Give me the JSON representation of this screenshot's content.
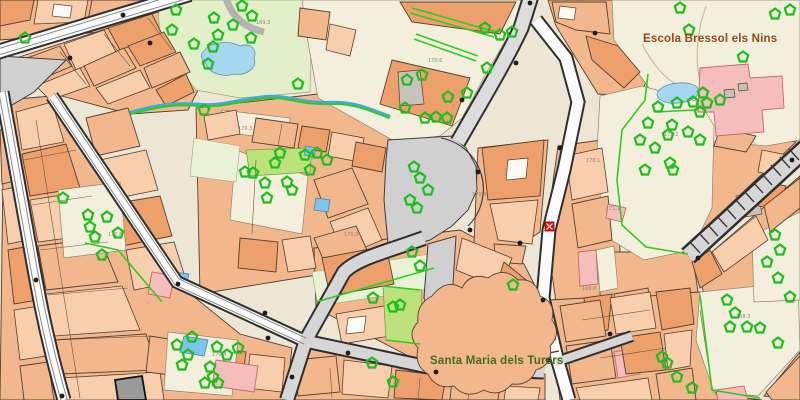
{
  "labels": {
    "poi_school": "Escola Bressol els Nins",
    "poi_church": "Santa Maria dels Turers"
  },
  "spot_heights": [
    {
      "value": "169.3"
    },
    {
      "value": "170.3"
    },
    {
      "value": "170.6"
    },
    {
      "value": "170.4"
    },
    {
      "value": "170.9"
    },
    {
      "value": "170.4"
    },
    {
      "value": "170.8"
    },
    {
      "value": "169.8"
    },
    {
      "value": "170.2"
    },
    {
      "value": "168.3"
    },
    {
      "value": "170.1"
    },
    {
      "value": "171.1"
    }
  ],
  "icons": {
    "tree": "pentagon-tree-icon",
    "marker": "red-square-x-icon"
  },
  "marker": {
    "name": "red-cross-marker"
  },
  "colors": {
    "tree_green": "#1DBE1D",
    "fence_green": "#2ECC1F",
    "water_blue": "#A6D7F0",
    "pool_blue": "#7FC4EA",
    "plaza_gray": "#D0D0D0",
    "park_green": "#E3EFC8",
    "grass_green": "#BCE27C",
    "pink": "#F6BDBD",
    "marker_red": "#E3170A",
    "label_brown": "#8E4A1E",
    "label_green": "#456B1D"
  }
}
